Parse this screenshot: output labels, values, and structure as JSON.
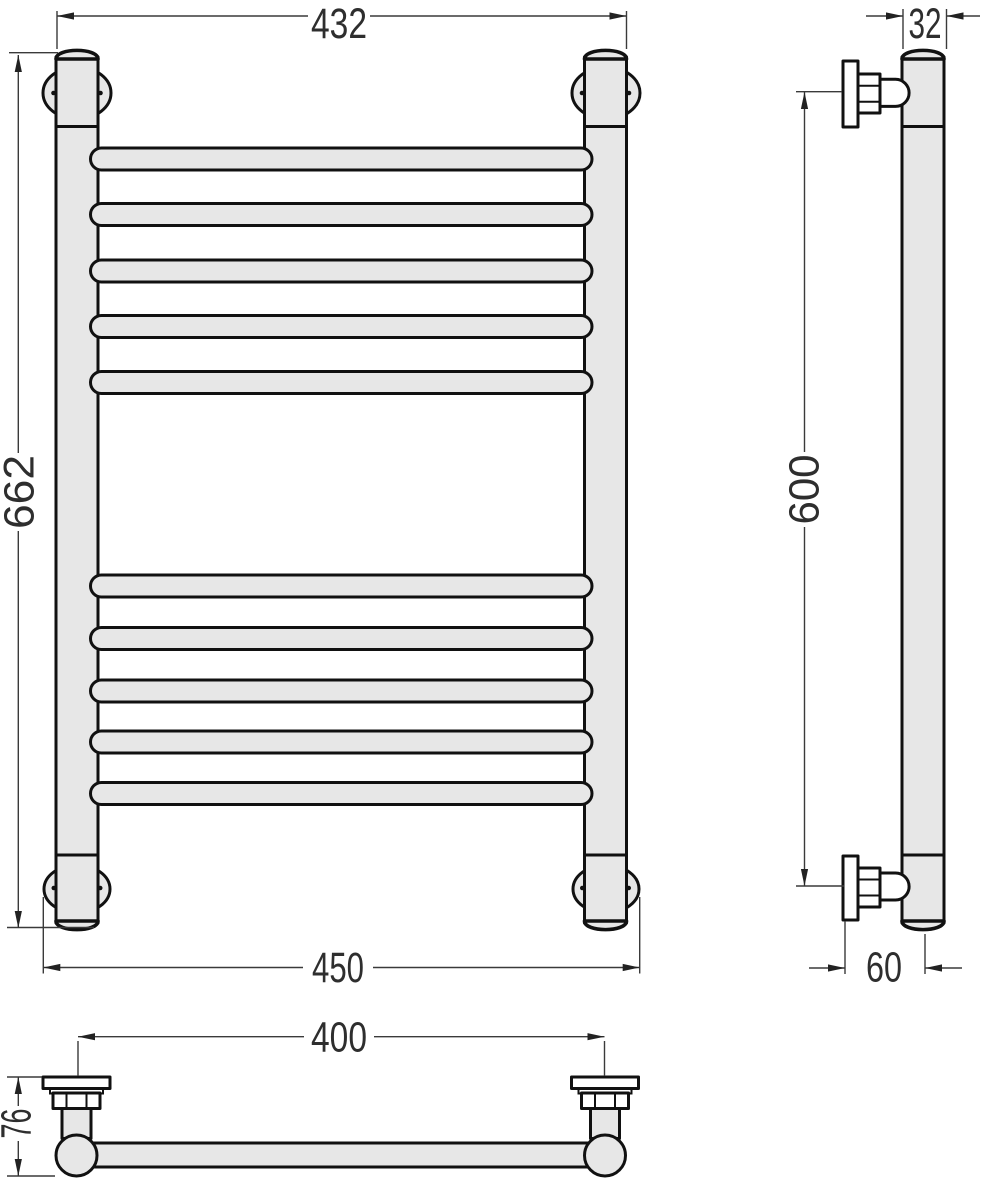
{
  "drawing": {
    "dimensions": {
      "front_top_width": "432",
      "front_height": "662",
      "front_bottom_width": "450",
      "side_top_depth": "32",
      "side_height": "600",
      "side_bottom_offset": "60",
      "plan_mount_width": "400",
      "plan_depth": "76"
    },
    "colors": {
      "outline": "#111111",
      "dimension_line": "#3a3a3a",
      "body_fill": "#e7e7e7",
      "bracket_fill": "#ffffff",
      "background": "#ffffff"
    }
  }
}
